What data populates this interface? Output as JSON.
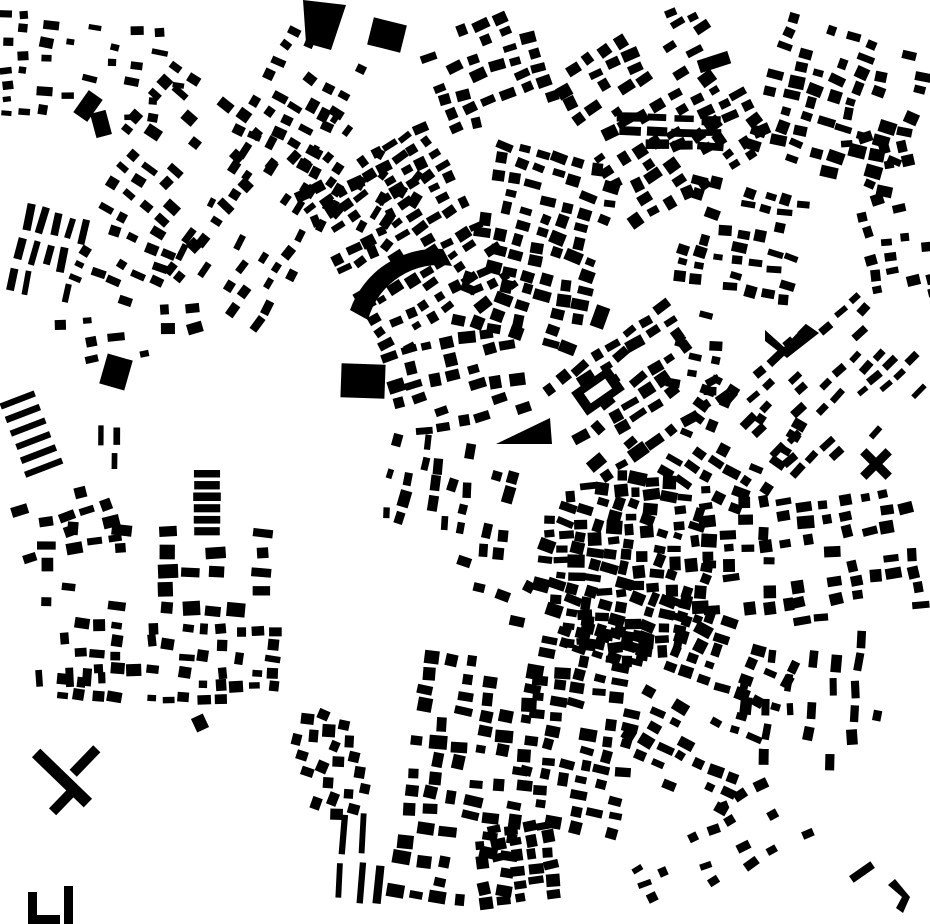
{
  "canvas": {
    "width": 930,
    "height": 924,
    "background": "#ffffff",
    "building_color": "#000000",
    "kind": "figure-ground-city-map"
  },
  "map": {
    "districts": [
      {
        "name": "tl-west-edge",
        "cx": 18,
        "cy": 65,
        "w": 38,
        "h": 115,
        "rot": 0,
        "bw": 10,
        "bh": 7,
        "gx": 16,
        "gy": 14,
        "p": 0.6,
        "js": 0.3,
        "jp": 1.5,
        "jr": 8
      },
      {
        "name": "tl-scatter",
        "cx": 115,
        "cy": 72,
        "w": 160,
        "h": 100,
        "rot": 5,
        "bw": 12,
        "bh": 8,
        "gx": 22,
        "gy": 17,
        "p": 0.5,
        "js": 0.35,
        "jp": 2,
        "jr": 10
      },
      {
        "name": "tl-hill-grid",
        "cx": 185,
        "cy": 160,
        "w": 150,
        "h": 150,
        "rot": 38,
        "bw": 13,
        "bh": 9,
        "gx": 21,
        "gy": 16,
        "p": 0.5,
        "js": 0.3,
        "jp": 2,
        "jr": 7
      },
      {
        "name": "tl-diag-band",
        "cx": 258,
        "cy": 228,
        "w": 185,
        "h": 120,
        "rot": -57,
        "bw": 13,
        "bh": 8,
        "gx": 20,
        "gy": 15,
        "p": 0.45,
        "js": 0.3,
        "jp": 2,
        "jr": 7
      },
      {
        "name": "l-bar-rows",
        "cx": 50,
        "cy": 258,
        "w": 75,
        "h": 100,
        "rot": 14,
        "bw": 7,
        "bh": 23,
        "gx": 14,
        "gy": 32,
        "p": 0.85,
        "js": 0.2,
        "jp": 1,
        "jr": 4
      },
      {
        "name": "l-diag2",
        "cx": 122,
        "cy": 258,
        "w": 90,
        "h": 90,
        "rot": 25,
        "bw": 12,
        "bh": 8,
        "gx": 19,
        "gy": 15,
        "p": 0.5,
        "js": 0.3,
        "jp": 2,
        "jr": 7
      },
      {
        "name": "tl-ne-fabric",
        "cx": 300,
        "cy": 98,
        "w": 95,
        "h": 125,
        "rot": 30,
        "bw": 12,
        "bh": 9,
        "gx": 19,
        "gy": 16,
        "p": 0.5,
        "js": 0.3,
        "jp": 2,
        "jr": 8
      },
      {
        "name": "l-mid-scatter",
        "cx": 135,
        "cy": 345,
        "w": 165,
        "h": 80,
        "rot": -8,
        "bw": 13,
        "bh": 9,
        "gx": 26,
        "gy": 20,
        "p": 0.4,
        "js": 0.35,
        "jp": 2,
        "jr": 9
      },
      {
        "name": "l-stripes",
        "cx": 29,
        "cy": 435,
        "w": 40,
        "h": 88,
        "rot": -21,
        "bw": 38,
        "bh": 6.5,
        "gx": 44,
        "gy": 14.5,
        "p": 1,
        "js": 0.05,
        "jp": 0,
        "jr": 0
      },
      {
        "name": "l-small-bars",
        "cx": 109,
        "cy": 448,
        "w": 32,
        "h": 52,
        "rot": 2,
        "bw": 6,
        "bh": 18,
        "gx": 15,
        "gy": 26,
        "p": 0.85,
        "js": 0.15,
        "jp": 1,
        "jr": 3
      },
      {
        "name": "l-bar-stack",
        "cx": 206,
        "cy": 502,
        "w": 28,
        "h": 68,
        "rot": 0,
        "bw": 26,
        "bh": 8,
        "gx": 30,
        "gy": 11.5,
        "p": 1,
        "js": 0.08,
        "jp": 0,
        "jr": 0
      },
      {
        "name": "lc-west-blocks",
        "cx": 72,
        "cy": 522,
        "w": 120,
        "h": 68,
        "rot": -14,
        "bw": 13,
        "bh": 9,
        "gx": 22,
        "gy": 17,
        "p": 0.5,
        "js": 0.3,
        "jp": 2,
        "jr": 8
      },
      {
        "name": "lc-grid",
        "cx": 160,
        "cy": 568,
        "w": 250,
        "h": 92,
        "rot": 2,
        "bw": 15,
        "bh": 11,
        "gx": 24,
        "gy": 19,
        "p": 0.55,
        "js": 0.35,
        "jp": 2,
        "jr": 6
      },
      {
        "name": "bl-grid",
        "cx": 165,
        "cy": 660,
        "w": 220,
        "h": 78,
        "rot": 2,
        "bw": 12,
        "bh": 9,
        "gx": 17.5,
        "gy": 14,
        "p": 0.62,
        "js": 0.35,
        "jp": 2,
        "jr": 8
      },
      {
        "name": "bl-west-row",
        "cx": 62,
        "cy": 682,
        "w": 95,
        "h": 28,
        "rot": 0,
        "bw": 8,
        "bh": 15,
        "gx": 16,
        "gy": 20,
        "p": 0.7,
        "js": 0.3,
        "jp": 1,
        "jr": 6
      },
      {
        "name": "bm-diamond",
        "cx": 333,
        "cy": 762,
        "w": 72,
        "h": 112,
        "rot": -17,
        "bw": 11,
        "bh": 11,
        "gx": 16.5,
        "gy": 16.5,
        "p": 0.8,
        "js": 0.2,
        "jp": 1,
        "jr": 12,
        "brot": 30,
        "clip": "ellipse"
      },
      {
        "name": "bm-vbars",
        "cx": 372,
        "cy": 858,
        "w": 78,
        "h": 92,
        "rot": 4,
        "bw": 7,
        "bh": 36,
        "gx": 19,
        "gy": 47,
        "p": 0.8,
        "js": 0.2,
        "jp": 2,
        "jr": 4
      },
      {
        "name": "bm-wedge",
        "cx": 462,
        "cy": 778,
        "w": 118,
        "h": 250,
        "rot": 8,
        "bw": 14,
        "bh": 11,
        "gx": 21,
        "gy": 17,
        "p": 0.68,
        "js": 0.35,
        "jp": 2,
        "jr": 6
      },
      {
        "name": "bm-dense",
        "cx": 578,
        "cy": 730,
        "w": 108,
        "h": 215,
        "rot": 10,
        "bw": 13,
        "bh": 10,
        "gx": 19,
        "gy": 15,
        "p": 0.72,
        "js": 0.35,
        "jp": 2,
        "jr": 7
      },
      {
        "name": "bm-bottom",
        "cx": 520,
        "cy": 862,
        "w": 92,
        "h": 82,
        "rot": -8,
        "bw": 12,
        "bh": 10,
        "gx": 17,
        "gy": 14,
        "p": 0.72,
        "js": 0.3,
        "jp": 2,
        "jr": 7
      },
      {
        "name": "old-town",
        "cx": 627,
        "cy": 567,
        "w": 180,
        "h": 190,
        "rot": 8,
        "bw": 13,
        "bh": 10,
        "gx": 16,
        "gy": 13,
        "p": 0.93,
        "js": 0.4,
        "jp": 2,
        "jr": 16,
        "clip": "ellipse"
      },
      {
        "name": "ot-east-col",
        "cx": 744,
        "cy": 552,
        "w": 88,
        "h": 142,
        "rot": -4,
        "bw": 13,
        "bh": 10,
        "gx": 19,
        "gy": 15,
        "p": 0.6,
        "js": 0.35,
        "jp": 2,
        "jr": 8
      },
      {
        "name": "ot-se",
        "cx": 724,
        "cy": 656,
        "w": 150,
        "h": 78,
        "rot": 22,
        "bw": 13,
        "bh": 10,
        "gx": 19,
        "gy": 15,
        "p": 0.62,
        "js": 0.35,
        "jp": 2,
        "jr": 8
      },
      {
        "name": "ot-south",
        "cx": 600,
        "cy": 641,
        "w": 88,
        "h": 46,
        "rot": 14,
        "bw": 12,
        "bh": 9,
        "gx": 18,
        "gy": 14,
        "p": 0.5,
        "js": 0.3,
        "jp": 2,
        "jr": 8
      },
      {
        "name": "ot-ne",
        "cx": 733,
        "cy": 446,
        "w": 112,
        "h": 118,
        "rot": 28,
        "bw": 13,
        "bh": 9,
        "gx": 19,
        "gy": 15,
        "p": 0.55,
        "js": 0.35,
        "jp": 2,
        "jr": 9
      },
      {
        "name": "ot-n-band",
        "cx": 630,
        "cy": 395,
        "w": 150,
        "h": 120,
        "rot": -35,
        "bw": 14,
        "bh": 10,
        "gx": 20,
        "gy": 15,
        "p": 0.68,
        "js": 0.35,
        "jp": 2,
        "jr": 7
      },
      {
        "name": "ot-west-col",
        "cx": 445,
        "cy": 498,
        "w": 108,
        "h": 128,
        "rot": -80,
        "bw": 13,
        "bh": 9,
        "gx": 19,
        "gy": 15,
        "p": 0.5,
        "js": 0.35,
        "jp": 2,
        "jr": 8
      },
      {
        "name": "ot-sw-sparse",
        "cx": 492,
        "cy": 592,
        "w": 100,
        "h": 55,
        "rot": 20,
        "bw": 12,
        "bh": 9,
        "gx": 24,
        "gy": 18,
        "p": 0.35,
        "js": 0.3,
        "jp": 2,
        "jr": 9
      },
      {
        "name": "c-dense-a",
        "cx": 405,
        "cy": 240,
        "w": 150,
        "h": 190,
        "rot": -30,
        "bw": 12,
        "bh": 9,
        "gx": 17,
        "gy": 14,
        "p": 0.75,
        "js": 0.35,
        "jp": 2,
        "jr": 8
      },
      {
        "name": "c-dense-b",
        "cx": 540,
        "cy": 250,
        "w": 140,
        "h": 200,
        "rot": 15,
        "bw": 13,
        "bh": 10,
        "gx": 19,
        "gy": 15,
        "p": 0.7,
        "js": 0.35,
        "jp": 2,
        "jr": 8
      },
      {
        "name": "c-mid",
        "cx": 455,
        "cy": 382,
        "w": 140,
        "h": 95,
        "rot": -12,
        "bw": 13,
        "bh": 10,
        "gx": 20,
        "gy": 16,
        "p": 0.6,
        "js": 0.35,
        "jp": 2,
        "jr": 8
      },
      {
        "name": "c-nw-band",
        "cx": 350,
        "cy": 178,
        "w": 85,
        "h": 160,
        "rot": -55,
        "bw": 12,
        "bh": 8,
        "gx": 18,
        "gy": 14,
        "p": 0.45,
        "js": 0.3,
        "jp": 2,
        "jr": 8
      },
      {
        "name": "c-top-grid",
        "cx": 492,
        "cy": 70,
        "w": 128,
        "h": 108,
        "rot": -20,
        "bw": 13,
        "bh": 9,
        "gx": 20,
        "gy": 15,
        "p": 0.6,
        "js": 0.3,
        "jp": 2,
        "jr": 7
      },
      {
        "name": "tr-dense",
        "cx": 660,
        "cy": 112,
        "w": 168,
        "h": 178,
        "rot": -30,
        "bw": 13,
        "bh": 10,
        "gx": 19,
        "gy": 15,
        "p": 0.68,
        "js": 0.35,
        "jp": 2,
        "jr": 8
      },
      {
        "name": "tr-east",
        "cx": 845,
        "cy": 105,
        "w": 168,
        "h": 148,
        "rot": 18,
        "bw": 13,
        "bh": 10,
        "gx": 20,
        "gy": 15,
        "p": 0.6,
        "js": 0.35,
        "jp": 2,
        "jr": 8
      },
      {
        "name": "tr-hub-south",
        "cx": 737,
        "cy": 242,
        "w": 118,
        "h": 118,
        "rot": 12,
        "bw": 12,
        "bh": 9,
        "gx": 18,
        "gy": 14,
        "p": 0.6,
        "js": 0.35,
        "jp": 2,
        "jr": 9
      },
      {
        "name": "tr-right-edge",
        "cx": 892,
        "cy": 215,
        "w": 75,
        "h": 175,
        "rot": -12,
        "bw": 12,
        "bh": 9,
        "gx": 18,
        "gy": 15,
        "p": 0.5,
        "js": 0.3,
        "jp": 2,
        "jr": 8
      },
      {
        "name": "tr-bar-row",
        "cx": 664,
        "cy": 131,
        "w": 95,
        "h": 38,
        "rot": 2,
        "bw": 22,
        "bh": 8,
        "gx": 27,
        "gy": 13,
        "p": 0.85,
        "js": 0.2,
        "jp": 1,
        "jr": 3
      },
      {
        "name": "r-diag-rows",
        "cx": 830,
        "cy": 395,
        "w": 170,
        "h": 145,
        "rot": -44,
        "bw": 14,
        "bh": 7,
        "gx": 20,
        "gy": 14,
        "p": 0.5,
        "js": 0.25,
        "jp": 2,
        "jr": 5
      },
      {
        "name": "r-grid",
        "cx": 856,
        "cy": 556,
        "w": 148,
        "h": 128,
        "rot": -8,
        "bw": 13,
        "bh": 10,
        "gx": 20,
        "gy": 16,
        "p": 0.6,
        "js": 0.35,
        "jp": 2,
        "jr": 7
      },
      {
        "name": "r-mid-col",
        "cx": 700,
        "cy": 350,
        "w": 58,
        "h": 88,
        "rot": 10,
        "bw": 12,
        "bh": 9,
        "gx": 18,
        "gy": 15,
        "p": 0.45,
        "js": 0.3,
        "jp": 2,
        "jr": 8
      },
      {
        "name": "br-fabric",
        "cx": 690,
        "cy": 746,
        "w": 140,
        "h": 108,
        "rot": 24,
        "bw": 13,
        "bh": 9,
        "gx": 19,
        "gy": 15,
        "p": 0.5,
        "js": 0.35,
        "jp": 2,
        "jr": 8
      },
      {
        "name": "br-scatter",
        "cx": 812,
        "cy": 700,
        "w": 155,
        "h": 155,
        "rot": 4,
        "bw": 9,
        "bh": 14,
        "gx": 22,
        "gy": 25,
        "p": 0.45,
        "js": 0.3,
        "jp": 2,
        "jr": 8
      },
      {
        "name": "br-bottom",
        "cx": 718,
        "cy": 846,
        "w": 185,
        "h": 85,
        "rot": -28,
        "bw": 12,
        "bh": 8,
        "gx": 21,
        "gy": 16,
        "p": 0.4,
        "js": 0.3,
        "jp": 2,
        "jr": 9
      }
    ],
    "landmarks": [
      {
        "name": "quad-top",
        "kind": "poly",
        "points": "303,0 346,5 331,50 306,43"
      },
      {
        "name": "big-rect-top",
        "kind": "rect",
        "cx": 387,
        "cy": 35,
        "w": 34,
        "h": 28,
        "rot": 14
      },
      {
        "name": "center-square",
        "kind": "rect",
        "cx": 363,
        "cy": 381,
        "w": 44,
        "h": 34,
        "rot": 2
      },
      {
        "name": "left-square",
        "kind": "rect",
        "cx": 116,
        "cy": 372,
        "w": 26,
        "h": 31,
        "rot": 16
      },
      {
        "name": "arc-building",
        "kind": "path",
        "d": "M 368 320 A 74 74 0 0 1 452 266 L 443 249 A 92 92 0 0 0 350 310 Z"
      },
      {
        "name": "center-triangle",
        "kind": "poly",
        "points": "496,444 550,418 552,444"
      },
      {
        "name": "ne-vshape",
        "kind": "poly",
        "points": "765,330 784,347 806,324 819,333 787,358 765,341"
      },
      {
        "name": "x-building-a",
        "kind": "rect",
        "cx": 876,
        "cy": 464,
        "w": 36,
        "h": 9,
        "rot": 45
      },
      {
        "name": "x-building-b",
        "kind": "rect",
        "cx": 876,
        "cy": 464,
        "w": 36,
        "h": 9,
        "rot": -45
      },
      {
        "name": "courtyard-outer",
        "kind": "rect",
        "cx": 598,
        "cy": 391,
        "w": 46,
        "h": 28,
        "rot": -35
      },
      {
        "name": "courtyard-inner",
        "kind": "rect",
        "cx": 598,
        "cy": 391,
        "w": 26,
        "h": 12,
        "rot": -35,
        "color": "bg"
      },
      {
        "name": "bl-t-bar-long",
        "kind": "rect",
        "cx": 62,
        "cy": 778,
        "w": 72,
        "h": 12,
        "rot": 44
      },
      {
        "name": "bl-t-bar-top",
        "kind": "rect",
        "cx": 85,
        "cy": 761,
        "w": 34,
        "h": 10,
        "rot": -46
      },
      {
        "name": "bl-t-bar-foot",
        "kind": "rect",
        "cx": 63,
        "cy": 801,
        "w": 30,
        "h": 10,
        "rot": -46
      },
      {
        "name": "bl-L1",
        "kind": "poly",
        "points": "28,892 37,892 37,915 60,915 60,924 28,924"
      },
      {
        "name": "bl-L2",
        "kind": "poly",
        "points": "64,886 73,886 73,924 64,924"
      },
      {
        "name": "br-bar",
        "kind": "rect",
        "cx": 862,
        "cy": 872,
        "w": 26,
        "h": 8,
        "rot": -35
      },
      {
        "name": "br-L",
        "kind": "poly",
        "points": "888,885 895,879 910,897 903,913 896,908 902,897"
      },
      {
        "name": "tl-blob-a",
        "kind": "rect",
        "cx": 88,
        "cy": 106,
        "w": 17,
        "h": 27,
        "rot": 35
      },
      {
        "name": "tl-blob-b",
        "kind": "rect",
        "cx": 101,
        "cy": 124,
        "w": 16,
        "h": 25,
        "rot": -15
      },
      {
        "name": "tr-lone-bar",
        "kind": "rect",
        "cx": 714,
        "cy": 62,
        "w": 32,
        "h": 13,
        "rot": -18
      },
      {
        "name": "bl-lone-block",
        "kind": "rect",
        "cx": 200,
        "cy": 723,
        "w": 13,
        "h": 15,
        "rot": -25
      },
      {
        "name": "bm-lone-block",
        "kind": "rect",
        "cx": 600,
        "cy": 317,
        "w": 14,
        "h": 22,
        "rot": 20
      }
    ]
  }
}
